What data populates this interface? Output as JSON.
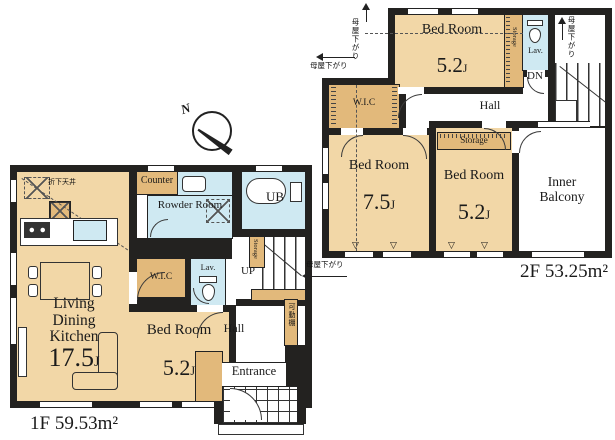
{
  "palette": {
    "wall": "#232220",
    "room": "#f2d7a7",
    "closet": "#e2b97b",
    "wet": "#cfe9f2",
    "white": "#ffffff"
  },
  "compass": {
    "north_label": "N"
  },
  "floor1": {
    "area_label": "1F 59.53m²",
    "ldk": {
      "name": "Living Dining Kitchen",
      "size": "17.5",
      "unit": "J"
    },
    "bedroom": {
      "name": "Bed Room",
      "size": "5.2",
      "unit": "J"
    },
    "counter": "Counter",
    "powder_room": "Rowder Room",
    "bath": "UB",
    "wic": "W.I.C",
    "lav": "Lav.",
    "hall": "Hall",
    "entrance": "Entrance",
    "stairs_up": "UP",
    "storage": "Storage",
    "movable_shelf": "可動棚",
    "dropped_ceiling": "折下天井"
  },
  "floor2": {
    "area_label": "2F 53.25m²",
    "bedroom_top": {
      "name": "Bed Room",
      "size": "5.2",
      "unit": "J"
    },
    "bedroom_left": {
      "name": "Bed Room",
      "size": "7.5",
      "unit": "J"
    },
    "bedroom_right": {
      "name": "Bed Room",
      "size": "5.2",
      "unit": "J"
    },
    "wic": "W.I.C",
    "lav": "Lav.",
    "hall": "Hall",
    "stairs_down": "DN",
    "storage_side": "Storage",
    "storage_mid": "Storage",
    "inner_balcony": "Inner Balcony",
    "roof_slope": "母屋下がり",
    "window_symbol": "▽"
  }
}
